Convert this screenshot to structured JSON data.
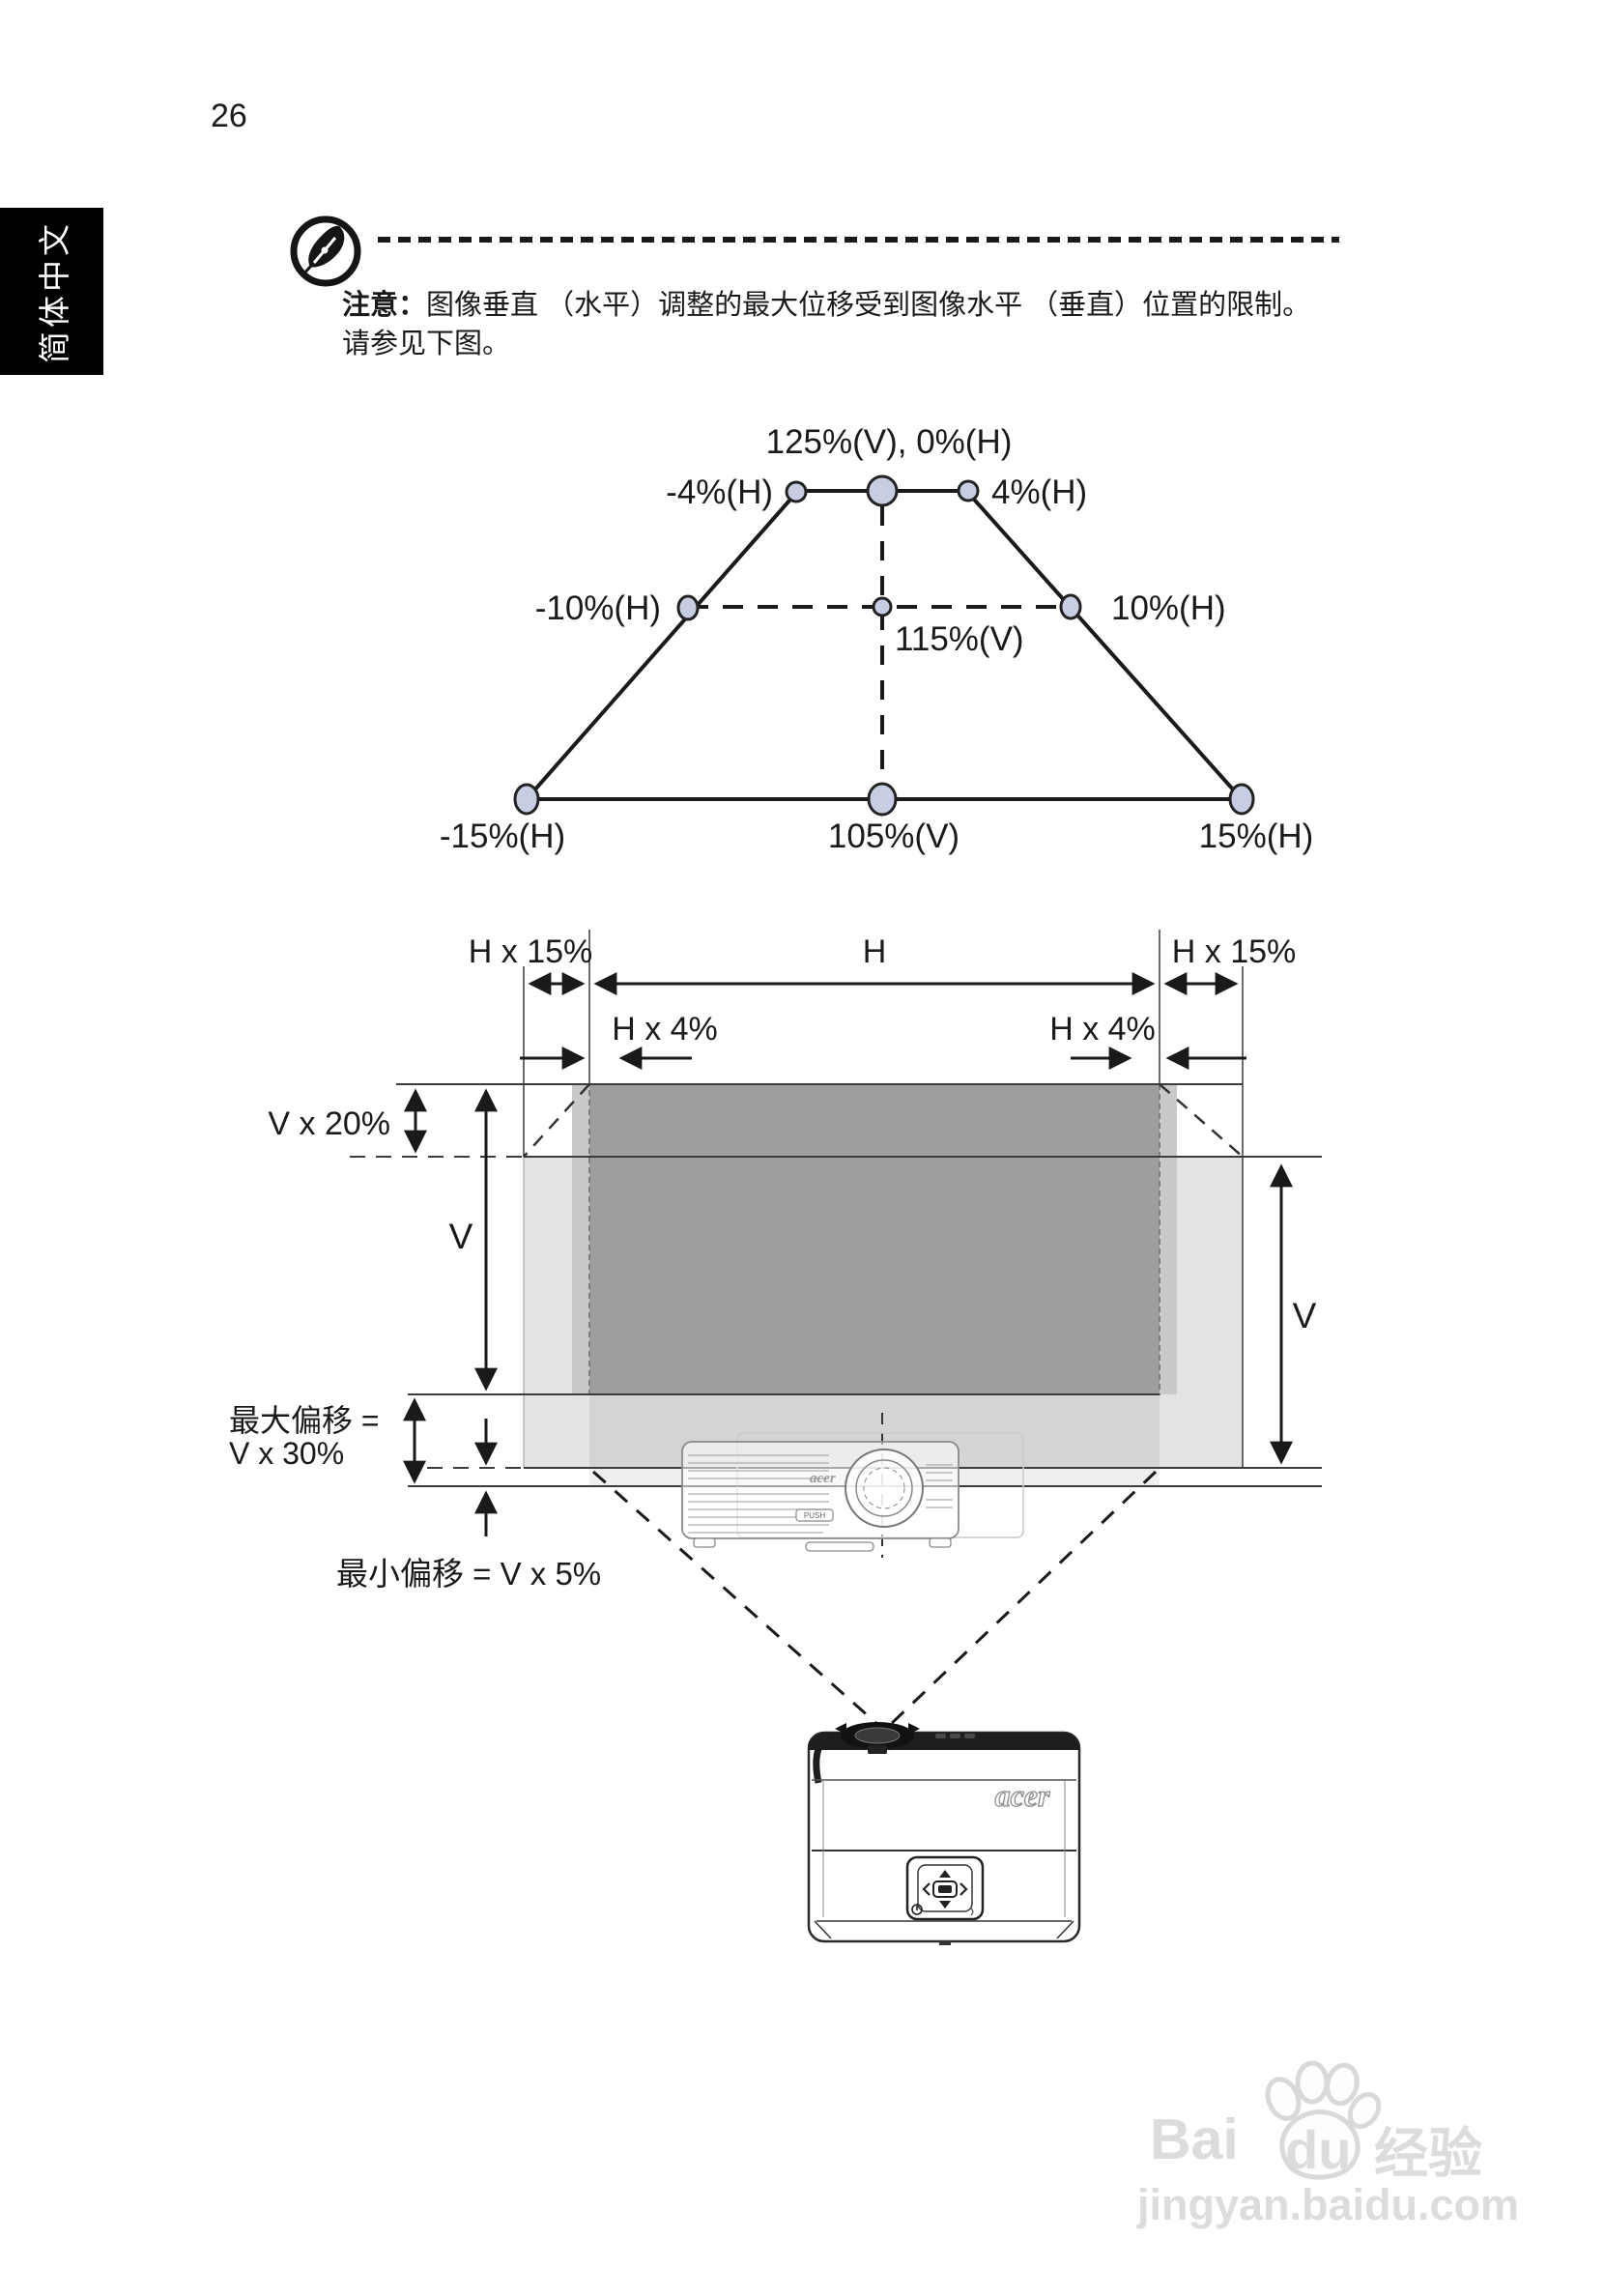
{
  "page": {
    "number": "26"
  },
  "sidebar": {
    "label": "简体中文"
  },
  "note": {
    "prefix": "注意：",
    "line1": "图像垂直 （水平）调整的最大位移受到图像水平 （垂直）位置的限制。",
    "line2": "请参见下图。"
  },
  "trapezoid": {
    "top": "125%(V), 0%(H)",
    "top_left": "-4%(H)",
    "top_right": "4%(H)",
    "mid_left": "-10%(H)",
    "mid_right": "10%(H)",
    "mid_center": "115%(V)",
    "bottom_left": "-15%(H)",
    "bottom_center": "105%(V)",
    "bottom_right": "15%(H)"
  },
  "offset_diagram": {
    "h_15_left": "H x 15%",
    "h": "H",
    "h_15_right": "H x 15%",
    "h_4_left": "H x 4%",
    "h_4_right": "H x 4%",
    "v_20": "V x 20%",
    "v_left": "V",
    "v_right": "V",
    "max_offset_line1": "最大偏移 =",
    "max_offset_line2": "V x 30%",
    "min_offset": "最小偏移 = V x 5%"
  },
  "projector": {
    "brand_small": "acer",
    "push_button": "PUSH",
    "brand_large": "acer"
  },
  "watermark": {
    "part1": "Bai",
    "part2": "du",
    "part3": "经验",
    "url": "jingyan.baidu.com"
  },
  "colors": {
    "node_fill": "#c7cee3",
    "dark_rect": "#9e9e9e",
    "light_rect": "#e3e3e3",
    "lower_band": "#d4d4d4",
    "side_strip": "#c9c9c9",
    "sub_band": "#efefef"
  }
}
